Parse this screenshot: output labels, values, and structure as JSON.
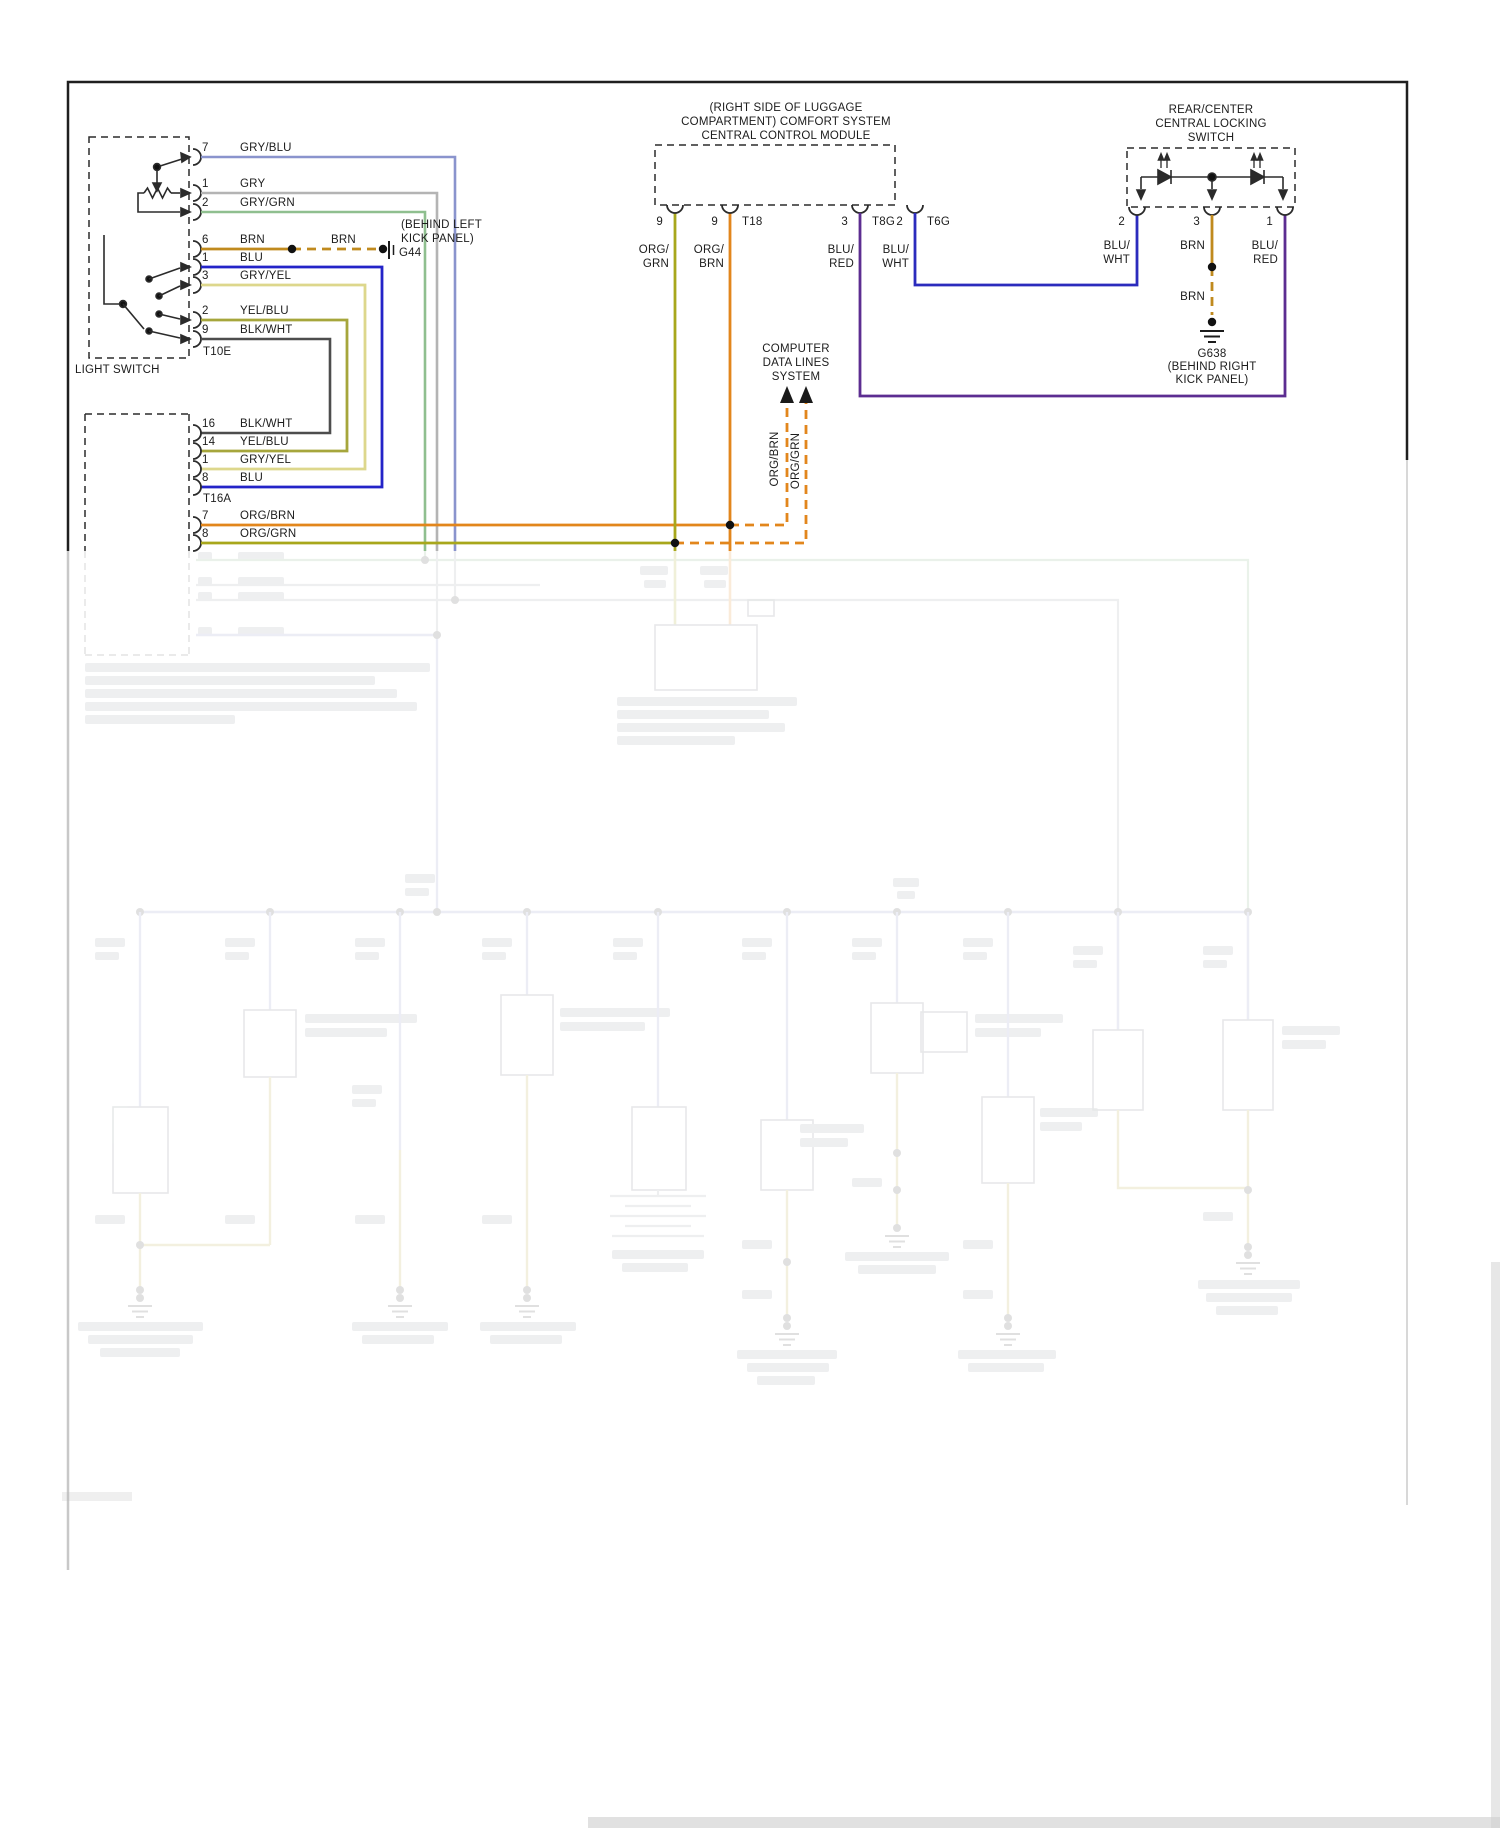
{
  "diagram_type": "wiring-schematic",
  "colors": {
    "gry_blu": "#8a94cd",
    "gry": "#b4b4b4",
    "gry_grn": "#8fbf8f",
    "brn": "#c08a1e",
    "blu": "#2323c8",
    "gry_yel": "#ddd78c",
    "yel_blu": "#a6a63c",
    "blk_wht": "#4d4d4d",
    "org_brn": "#e2861c",
    "org_grn": "#a8a71c",
    "blu_red": "#5c2d91",
    "blu_wht": "#2b2bbd"
  },
  "light_switch": {
    "label": "LIGHT SWITCH",
    "connector": "T10E",
    "pins": [
      {
        "num": "7",
        "wire": "GRY/BLU"
      },
      {
        "num": "1",
        "wire": "GRY"
      },
      {
        "num": "2",
        "wire": "GRY/GRN"
      },
      {
        "num": "6",
        "wire": "BRN"
      },
      {
        "num": "1",
        "wire": "BLU"
      },
      {
        "num": "3",
        "wire": "GRY/YEL"
      },
      {
        "num": "2",
        "wire": "YEL/BLU"
      },
      {
        "num": "9",
        "wire": "BLK/WHT"
      }
    ]
  },
  "g44": {
    "brn": "BRN",
    "note1": "(BEHIND LEFT",
    "note2": "KICK PANEL)",
    "name": "G44"
  },
  "t16a": {
    "connector": "T16A",
    "pins": [
      {
        "num": "16",
        "wire": "BLK/WHT"
      },
      {
        "num": "14",
        "wire": "YEL/BLU"
      },
      {
        "num": "1",
        "wire": "GRY/YEL"
      },
      {
        "num": "8",
        "wire": "BLU"
      },
      {
        "num": "7",
        "wire": "ORG/BRN"
      },
      {
        "num": "8",
        "wire": "ORG/GRN"
      }
    ]
  },
  "module": {
    "title1": "(RIGHT SIDE OF LUGGAGE",
    "title2": "COMPARTMENT) COMFORT SYSTEM",
    "title3": "CENTRAL CONTROL MODULE",
    "pins": [
      {
        "num": "9",
        "conn": "",
        "w1": "ORG/",
        "w2": "GRN"
      },
      {
        "num": "9",
        "conn": "T18",
        "w1": "ORG/",
        "w2": "BRN"
      },
      {
        "num": "3",
        "conn": "T8G",
        "w1": "BLU/",
        "w2": "RED"
      },
      {
        "num": "2",
        "conn": "T6G",
        "w1": "BLU/",
        "w2": "WHT"
      }
    ]
  },
  "computer": {
    "line1": "COMPUTER",
    "line2": "DATA LINES",
    "line3": "SYSTEM",
    "bus1": "ORG/BRN",
    "bus2": "ORG/GRN"
  },
  "lock": {
    "title1": "REAR/CENTER",
    "title2": "CENTRAL LOCKING",
    "title3": "SWITCH",
    "pins": [
      {
        "num": "2",
        "w1": "BLU/",
        "w2": "WHT"
      },
      {
        "num": "3",
        "w1": "BRN",
        "w2": ""
      },
      {
        "num": "1",
        "w1": "BLU/",
        "w2": "RED"
      }
    ],
    "brn": "BRN",
    "ground_name": "G638",
    "ground_note1": "(BEHIND RIGHT",
    "ground_note2": "KICK PANEL)"
  }
}
